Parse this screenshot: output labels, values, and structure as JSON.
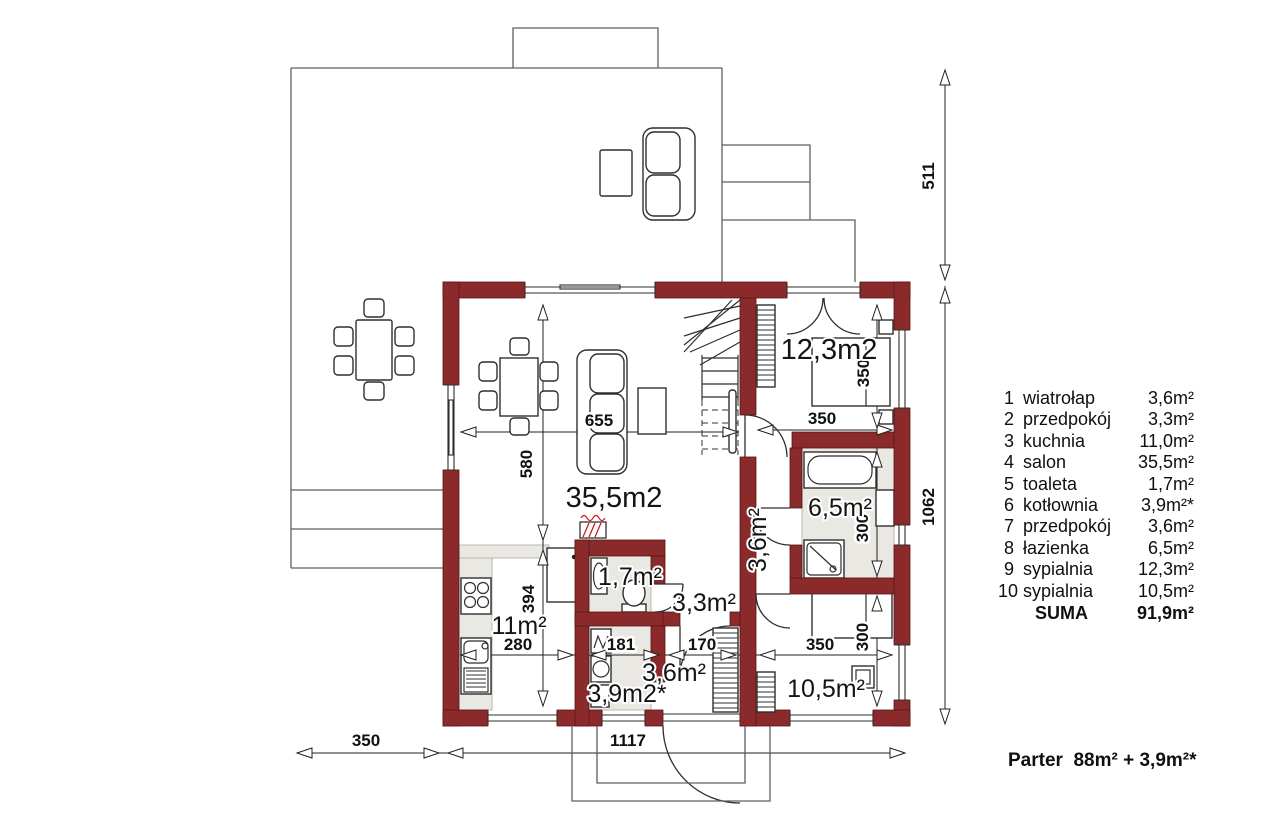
{
  "plan": {
    "room_labels": {
      "salon": "35,5m2",
      "sypialnia9": "12,3m2",
      "lazienka": "6,5m²",
      "przedpokoj7": "3,6m²",
      "toaleta": "1,7m²",
      "przedpokoj2": "3,3m²",
      "kuchnia": "11m²",
      "kotlownia": "3,9m2*",
      "wiatrolap": "3,6m²",
      "sypialnia10": "10,5m²"
    },
    "dimensions": {
      "terrace_height": "511",
      "house_height": "1062",
      "terrace_width": "350",
      "house_width": "1117",
      "salon_width": "655",
      "salon_depth": "580",
      "kitchen_depth": "394",
      "kitchen_width": "280",
      "kotlownia_width": "181",
      "wiatrolap_width": "170",
      "sypialnia9_width": "350",
      "sypialnia9_depth": "350",
      "lazienka_depth": "300",
      "sypialnia10_width": "350",
      "sypialnia10_depth": "300"
    }
  },
  "legend": {
    "rows": [
      {
        "num": "1",
        "name": "wiatrołap",
        "area": "3,6m²"
      },
      {
        "num": "2",
        "name": "przedpokój",
        "area": "3,3m²"
      },
      {
        "num": "3",
        "name": "kuchnia",
        "area": "11,0m²"
      },
      {
        "num": "4",
        "name": "salon",
        "area": "35,5m²"
      },
      {
        "num": "5",
        "name": "toaleta",
        "area": "1,7m²"
      },
      {
        "num": "6",
        "name": "kotłownia",
        "area": "3,9m²*"
      },
      {
        "num": "7",
        "name": "przedpokój",
        "area": "3,6m²"
      },
      {
        "num": "8",
        "name": "łazienka",
        "area": "6,5m²"
      },
      {
        "num": "9",
        "name": "sypialnia",
        "area": "12,3m²"
      },
      {
        "num": "10",
        "name": "sypialnia",
        "area": "10,5m²"
      }
    ],
    "suma_label": "SUMA",
    "suma_value": "91,9m²"
  },
  "footer": {
    "text": "Parter  88m² + 3,9m²*"
  },
  "colors": {
    "wall": "#8b2a2b",
    "floor_gray": "#eae8e3",
    "radiator": "#cc1111"
  }
}
